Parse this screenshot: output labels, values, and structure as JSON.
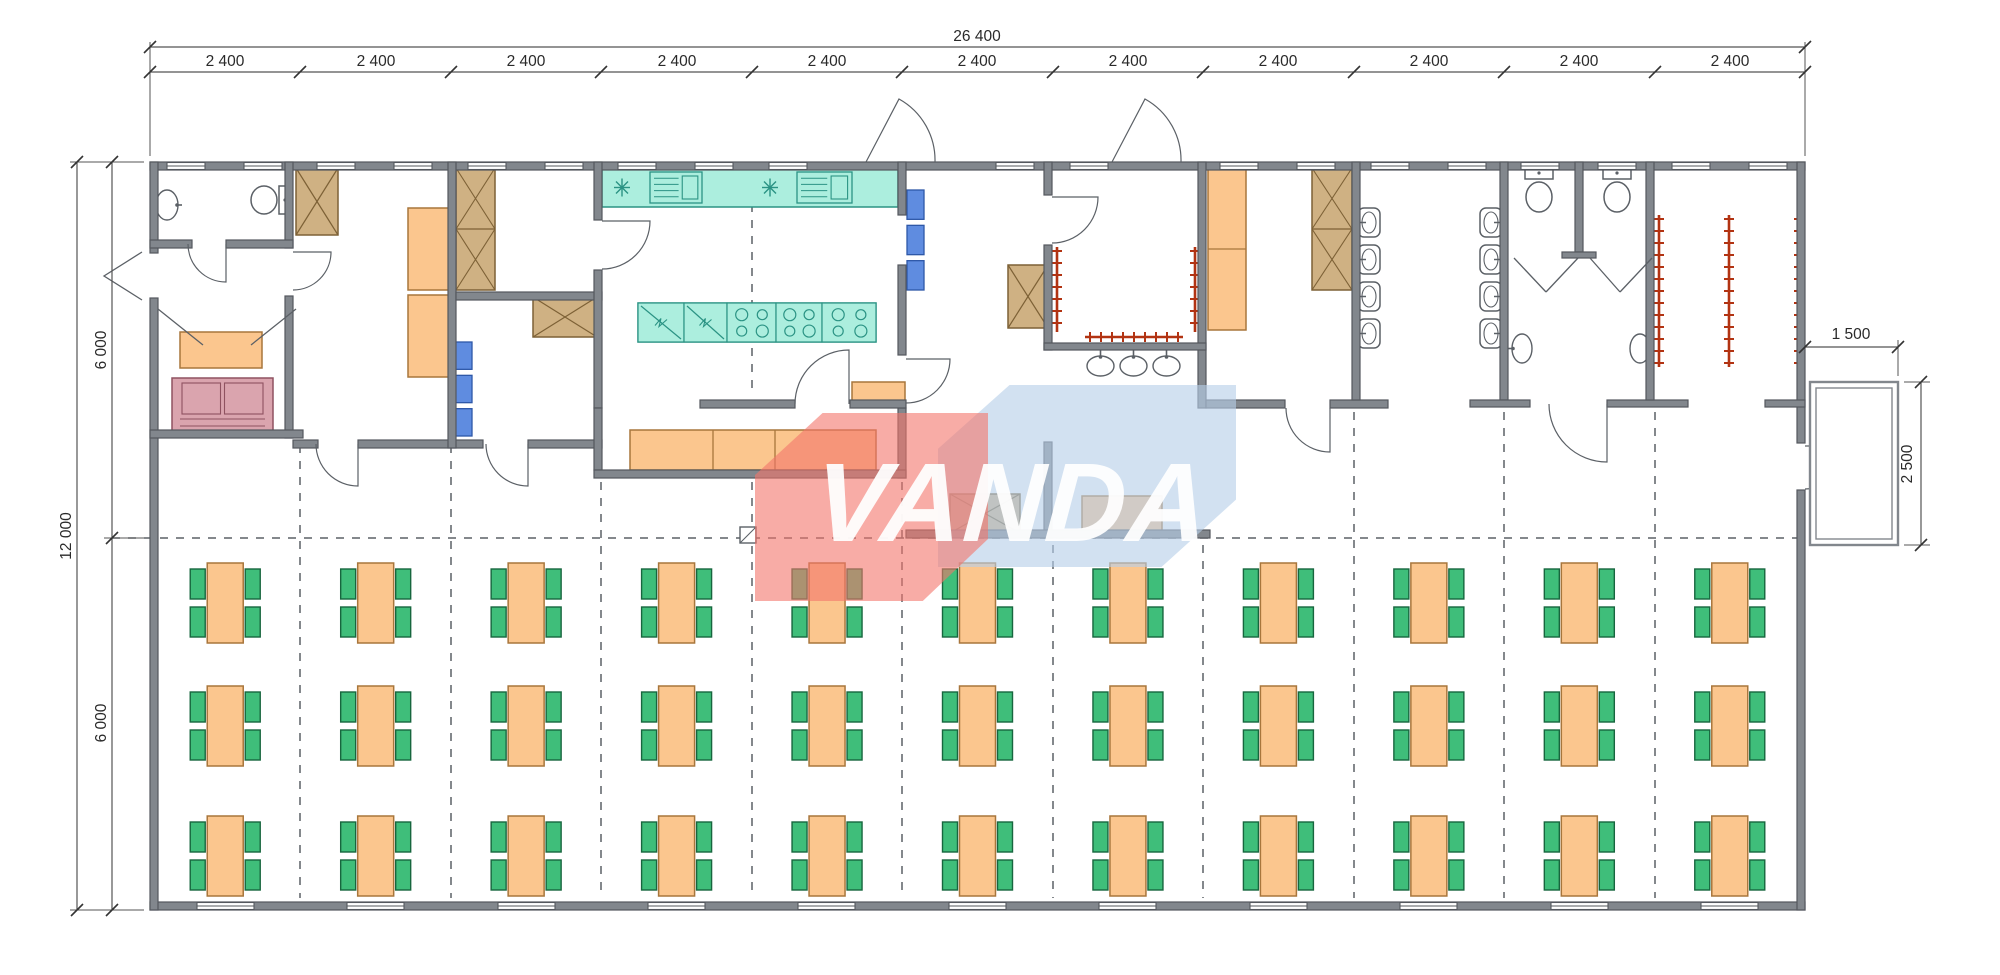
{
  "watermark": {
    "text": "VANDA",
    "red": "#f3746b",
    "blue": "#b7cfe9",
    "text_color": "#ffffff"
  },
  "dims": {
    "top_total": "26 400",
    "top_segments": [
      "2 400",
      "2 400",
      "2 400",
      "2 400",
      "2 400",
      "2 400",
      "2 400",
      "2 400",
      "2 400",
      "2 400",
      "2 400"
    ],
    "left_total": "12 000",
    "left_segments": [
      "6 000",
      "6 000"
    ],
    "porch_width": "1 500",
    "porch_depth": "2 500",
    "labels": [
      {
        "t": "26 400",
        "x": 977,
        "y": 41
      },
      {
        "t": "2 400",
        "x": 225,
        "y": 66
      },
      {
        "t": "2 400",
        "x": 376,
        "y": 66
      },
      {
        "t": "2 400",
        "x": 526,
        "y": 66
      },
      {
        "t": "2 400",
        "x": 677,
        "y": 66
      },
      {
        "t": "2 400",
        "x": 827,
        "y": 66
      },
      {
        "t": "2 400",
        "x": 977,
        "y": 66
      },
      {
        "t": "2 400",
        "x": 1128,
        "y": 66
      },
      {
        "t": "2 400",
        "x": 1278,
        "y": 66
      },
      {
        "t": "2 400",
        "x": 1429,
        "y": 66
      },
      {
        "t": "2 400",
        "x": 1579,
        "y": 66
      },
      {
        "t": "2 400",
        "x": 1730,
        "y": 66
      },
      {
        "t": "12 000",
        "x": 71,
        "y": 536,
        "r": 1
      },
      {
        "t": "6 000",
        "x": 106,
        "y": 350,
        "r": 1
      },
      {
        "t": "6 000",
        "x": 106,
        "y": 723,
        "r": 1
      },
      {
        "t": "1 500",
        "x": 1851,
        "y": 339
      },
      {
        "t": "2 500",
        "x": 1912,
        "y": 464,
        "r": 1
      }
    ],
    "dim_lines": [
      [
        150,
        47,
        1805,
        47
      ],
      [
        150,
        72,
        1805,
        72
      ],
      [
        77,
        162,
        77,
        910
      ],
      [
        112,
        162,
        112,
        910
      ],
      [
        1805,
        347,
        1898,
        347
      ],
      [
        1921,
        382,
        1921,
        545
      ]
    ],
    "ext_lines": [
      [
        150,
        156,
        150,
        42
      ],
      [
        1805,
        156,
        1805,
        42
      ],
      [
        144,
        162,
        70,
        162
      ],
      [
        144,
        910,
        70,
        910
      ],
      [
        144,
        538,
        104,
        538
      ],
      [
        1898,
        376,
        1898,
        340
      ],
      [
        1904,
        382,
        1930,
        382
      ],
      [
        1904,
        545,
        1930,
        545
      ]
    ],
    "ticks": [
      [
        150,
        47
      ],
      [
        1805,
        47
      ],
      [
        150,
        72
      ],
      [
        300,
        72
      ],
      [
        451,
        72
      ],
      [
        601,
        72
      ],
      [
        752,
        72
      ],
      [
        902,
        72
      ],
      [
        1053,
        72
      ],
      [
        1203,
        72
      ],
      [
        1354,
        72
      ],
      [
        1504,
        72
      ],
      [
        1655,
        72
      ],
      [
        1805,
        72
      ],
      [
        77,
        162
      ],
      [
        77,
        910
      ],
      [
        112,
        162
      ],
      [
        112,
        538
      ],
      [
        112,
        910
      ],
      [
        1805,
        347
      ],
      [
        1898,
        347
      ],
      [
        1921,
        382
      ],
      [
        1921,
        545
      ]
    ]
  },
  "colors": {
    "wall": "#82878d",
    "wallEdge": "#54585e",
    "line": "#5b6066",
    "dim": "#2a2a2a",
    "orange": "#fbc68e",
    "orangeEdge": "#a8763c",
    "tan": "#cfb183",
    "tanEdge": "#7d6136",
    "teal": "#aceede",
    "tealEdge": "#2b9384",
    "blue": "#5f8ce0",
    "blueEdge": "#2e57a8",
    "pink": "#daa4ae",
    "pinkEdge": "#8f5260",
    "green": "#3fbe7a",
    "greenEdge": "#17663e",
    "red": "#b23312",
    "white": "#ffffff"
  },
  "plan": {
    "building": [
      150,
      162,
      1655,
      748
    ],
    "walls": [
      [
        150,
        162,
        1655,
        8
      ],
      [
        150,
        902,
        1655,
        8
      ],
      [
        150,
        162,
        8,
        91
      ],
      [
        150,
        298,
        8,
        612
      ],
      [
        1797,
        162,
        8,
        281
      ],
      [
        1797,
        490,
        8,
        420
      ],
      [
        285,
        162,
        8,
        86
      ],
      [
        285,
        296,
        8,
        142
      ],
      [
        150,
        240,
        42,
        8
      ],
      [
        226,
        240,
        67,
        8
      ],
      [
        150,
        430,
        153,
        8
      ],
      [
        293,
        440,
        25,
        8
      ],
      [
        358,
        440,
        125,
        8
      ],
      [
        528,
        440,
        74,
        8
      ],
      [
        448,
        162,
        8,
        286
      ],
      [
        456,
        292,
        146,
        8
      ],
      [
        594,
        162,
        8,
        58
      ],
      [
        594,
        270,
        8,
        138
      ],
      [
        898,
        162,
        8,
        53
      ],
      [
        898,
        265,
        8,
        90
      ],
      [
        898,
        408,
        8,
        70
      ],
      [
        700,
        400,
        95,
        8
      ],
      [
        850,
        400,
        56,
        8
      ],
      [
        594,
        408,
        8,
        62
      ],
      [
        594,
        470,
        312,
        8
      ],
      [
        1044,
        162,
        8,
        33
      ],
      [
        1044,
        245,
        8,
        105
      ],
      [
        1044,
        442,
        8,
        96
      ],
      [
        1198,
        162,
        8,
        246
      ],
      [
        1044,
        343,
        162,
        7
      ],
      [
        906,
        530,
        304,
        8
      ],
      [
        1206,
        400,
        79,
        8
      ],
      [
        1330,
        400,
        58,
        8
      ],
      [
        1352,
        162,
        8,
        238
      ],
      [
        1500,
        162,
        8,
        238
      ],
      [
        1470,
        400,
        60,
        7
      ],
      [
        1607,
        400,
        81,
        7
      ],
      [
        1575,
        162,
        8,
        90
      ],
      [
        1562,
        252,
        34,
        6
      ],
      [
        1646,
        162,
        8,
        238
      ],
      [
        1765,
        400,
        40,
        7
      ]
    ],
    "windows": [
      {
        "x": 167,
        "y": 162,
        "w": 38
      },
      {
        "x": 244,
        "y": 162,
        "w": 38
      },
      {
        "x": 317,
        "y": 162,
        "w": 38
      },
      {
        "x": 394,
        "y": 162,
        "w": 38
      },
      {
        "x": 468,
        "y": 162,
        "w": 38
      },
      {
        "x": 545,
        "y": 162,
        "w": 38
      },
      {
        "x": 618,
        "y": 162,
        "w": 38
      },
      {
        "x": 695,
        "y": 162,
        "w": 38
      },
      {
        "x": 769,
        "y": 162,
        "w": 38
      },
      {
        "x": 996,
        "y": 162,
        "w": 38
      },
      {
        "x": 1070,
        "y": 162,
        "w": 38
      },
      {
        "x": 1220,
        "y": 162,
        "w": 38
      },
      {
        "x": 1297,
        "y": 162,
        "w": 38
      },
      {
        "x": 1371,
        "y": 162,
        "w": 38
      },
      {
        "x": 1448,
        "y": 162,
        "w": 38
      },
      {
        "x": 1521,
        "y": 162,
        "w": 38
      },
      {
        "x": 1598,
        "y": 162,
        "w": 38
      },
      {
        "x": 1672,
        "y": 162,
        "w": 38
      },
      {
        "x": 1749,
        "y": 162,
        "w": 38
      },
      {
        "x": 197,
        "y": 902,
        "w": 57
      },
      {
        "x": 347,
        "y": 902,
        "w": 57
      },
      {
        "x": 498,
        "y": 902,
        "w": 57
      },
      {
        "x": 648,
        "y": 902,
        "w": 57
      },
      {
        "x": 798,
        "y": 902,
        "w": 57
      },
      {
        "x": 949,
        "y": 902,
        "w": 57
      },
      {
        "x": 1099,
        "y": 902,
        "w": 57
      },
      {
        "x": 1250,
        "y": 902,
        "w": 57
      },
      {
        "x": 1400,
        "y": 902,
        "w": 57
      },
      {
        "x": 1551,
        "y": 902,
        "w": 57
      },
      {
        "x": 1701,
        "y": 902,
        "w": 57
      }
    ],
    "doors": [
      "M226,244 L226,282 A38,38 0 0 1 188,244",
      "M293,252 L331,252 A38,38 0 0 1 293,290",
      "M602,221 L650,221 A48,48 0 0 1 602,269",
      "M906,359 L950,359 A44,44 0 0 1 906,403",
      "M849,404 L849,350 A54,54 0 0 0 795,404",
      "M1052,197 L1098,197 A46,46 0 0 1 1052,243",
      "M866,162 L899,99 A70,70 0 0 1 935,162",
      "M1112,162 L1145,99 A70,70 0 0 1 1181,162",
      "M1330,408 L1330,452 A44,44 0 0 1 1286,408",
      "M1607,404 L1607,462 A58,58 0 0 1 1549,404",
      "M1805,446 L1848,446 A43,43 0 0 1 1805,489",
      "M358,444 L358,486 A42,42 0 0 1 316,444",
      "M528,444 L528,486 A42,42 0 0 1 486,444"
    ],
    "door_leaves": [
      [
        142,
        252,
        104,
        276,
        142,
        300
      ],
      [
        158,
        309,
        203,
        345
      ],
      [
        296,
        309,
        251,
        345
      ],
      [
        1514,
        258,
        1546,
        292
      ],
      [
        1578,
        258,
        1546,
        292
      ],
      [
        1590,
        258,
        1620,
        292
      ],
      [
        1652,
        258,
        1620,
        292
      ]
    ],
    "dashed_v": [
      [
        300,
        445,
        898
      ],
      [
        451,
        445,
        898
      ],
      [
        601,
        482,
        898
      ],
      [
        752,
        482,
        898
      ],
      [
        902,
        482,
        898
      ],
      [
        1053,
        545,
        898
      ],
      [
        1203,
        545,
        898
      ],
      [
        1354,
        412,
        898
      ],
      [
        1504,
        412,
        898
      ],
      [
        1655,
        412,
        898
      ],
      [
        752,
        172,
        396
      ]
    ],
    "dashed_h": [
      [
        538,
        112,
        1797
      ]
    ],
    "furniture": [
      {
        "t": "shelf",
        "x": 180,
        "y": 332,
        "w": 82,
        "h": 36
      },
      {
        "t": "shelf",
        "x": 408,
        "y": 208,
        "w": 42,
        "h": 82
      },
      {
        "t": "shelf",
        "x": 408,
        "y": 295,
        "w": 42,
        "h": 82
      },
      {
        "t": "shelf",
        "x": 852,
        "y": 382,
        "w": 53,
        "h": 20
      },
      {
        "t": "shelf",
        "x": 1082,
        "y": 496,
        "w": 80,
        "h": 35
      },
      {
        "t": "shelf2",
        "x": 1208,
        "y": 168,
        "w": 38,
        "h": 162
      },
      {
        "t": "prep",
        "x": 630,
        "y": 430,
        "w": 246,
        "h": 40,
        "xs": [
          713,
          775
        ]
      },
      {
        "t": "xbox",
        "x": 296,
        "y": 168,
        "w": 42,
        "h": 67
      },
      {
        "t": "xbox",
        "x": 533,
        "y": 297,
        "w": 64,
        "h": 40
      },
      {
        "t": "xbox",
        "x": 1008,
        "y": 265,
        "w": 40,
        "h": 63
      },
      {
        "t": "xbox",
        "x": 950,
        "y": 494,
        "w": 70,
        "h": 39
      },
      {
        "t": "xbox2",
        "x": 456,
        "y": 168,
        "w": 39,
        "h": 122
      },
      {
        "t": "xbox2",
        "x": 1312,
        "y": 168,
        "w": 40,
        "h": 122
      },
      {
        "t": "boxes3",
        "x": 452,
        "y": 342,
        "w": 20,
        "h": 94
      },
      {
        "t": "boxes3",
        "x": 907,
        "y": 190,
        "w": 17,
        "h": 100
      },
      {
        "t": "sofa",
        "x": 172,
        "y": 378,
        "w": 101,
        "h": 55
      },
      {
        "t": "counter",
        "x": 602,
        "y": 168,
        "w": 296,
        "h": 39,
        "stars": [
          622,
          770
        ],
        "mods": [
          [
            650,
            52
          ],
          [
            797,
            55
          ]
        ]
      },
      {
        "t": "island",
        "x": 638,
        "y": 303,
        "w": 238,
        "h": 39,
        "fr": [
          [
            638,
            46
          ],
          [
            684,
            43
          ]
        ],
        "st": [
          [
            727,
            49
          ],
          [
            776,
            46
          ],
          [
            822,
            54
          ]
        ]
      },
      {
        "t": "sink_up",
        "x": 1085,
        "y": 351,
        "w": 31,
        "h": 26
      },
      {
        "t": "sink_up",
        "x": 1118,
        "y": 351,
        "w": 31,
        "h": 26
      },
      {
        "t": "sink_up",
        "x": 1151,
        "y": 351,
        "w": 31,
        "h": 26
      },
      {
        "t": "sink_side",
        "x": 154,
        "y": 188,
        "w": 26,
        "h": 34,
        "side": "r"
      },
      {
        "t": "sink_side",
        "x": 1510,
        "y": 332,
        "w": 24,
        "h": 33,
        "side": "l"
      },
      {
        "t": "sink_side",
        "x": 1628,
        "y": 332,
        "w": 24,
        "h": 33,
        "side": "r"
      },
      {
        "t": "toilet_h",
        "x": 250,
        "y": 184,
        "w": 43,
        "h": 32
      },
      {
        "t": "toilet_v",
        "x": 1524,
        "y": 168,
        "w": 30,
        "h": 46
      },
      {
        "t": "toilet_v",
        "x": 1602,
        "y": 168,
        "w": 30,
        "h": 46
      },
      {
        "t": "urinal",
        "x": 1358,
        "y": 208,
        "side": "l"
      },
      {
        "t": "urinal",
        "x": 1358,
        "y": 245,
        "side": "l"
      },
      {
        "t": "urinal",
        "x": 1358,
        "y": 282,
        "side": "l"
      },
      {
        "t": "urinal",
        "x": 1358,
        "y": 319,
        "side": "l"
      },
      {
        "t": "urinal",
        "x": 1480,
        "y": 208,
        "side": "r"
      },
      {
        "t": "urinal",
        "x": 1480,
        "y": 245,
        "side": "r"
      },
      {
        "t": "urinal",
        "x": 1480,
        "y": 282,
        "side": "r"
      },
      {
        "t": "urinal",
        "x": 1480,
        "y": 319,
        "side": "r"
      },
      {
        "t": "marker",
        "x": 740,
        "y": 527,
        "w": 16,
        "h": 16
      }
    ],
    "hooks": [
      {
        "o": "v",
        "x": 1057,
        "a": 247,
        "b": 332
      },
      {
        "o": "v",
        "x": 1195,
        "a": 247,
        "b": 332
      },
      {
        "o": "v",
        "x": 1659,
        "a": 215,
        "b": 367
      },
      {
        "o": "v",
        "x": 1729,
        "a": 215,
        "b": 367
      },
      {
        "o": "v",
        "x": 1799,
        "a": 215,
        "b": 367
      },
      {
        "o": "h",
        "x": 337,
        "a": 1085,
        "b": 1183
      }
    ],
    "porch": {
      "outer": [
        1810,
        382,
        88,
        163
      ],
      "inner": [
        1816,
        388,
        76,
        151
      ]
    },
    "dining": {
      "left": 150,
      "bay_width": 150.4545,
      "bays": 11,
      "row_tops": [
        563,
        686,
        816
      ],
      "table_w": 36,
      "table_h": 80,
      "chair_w": 15,
      "chair_h": 30,
      "tables_per_row": 11,
      "rows": 3,
      "seats_per_table": 4
    }
  }
}
